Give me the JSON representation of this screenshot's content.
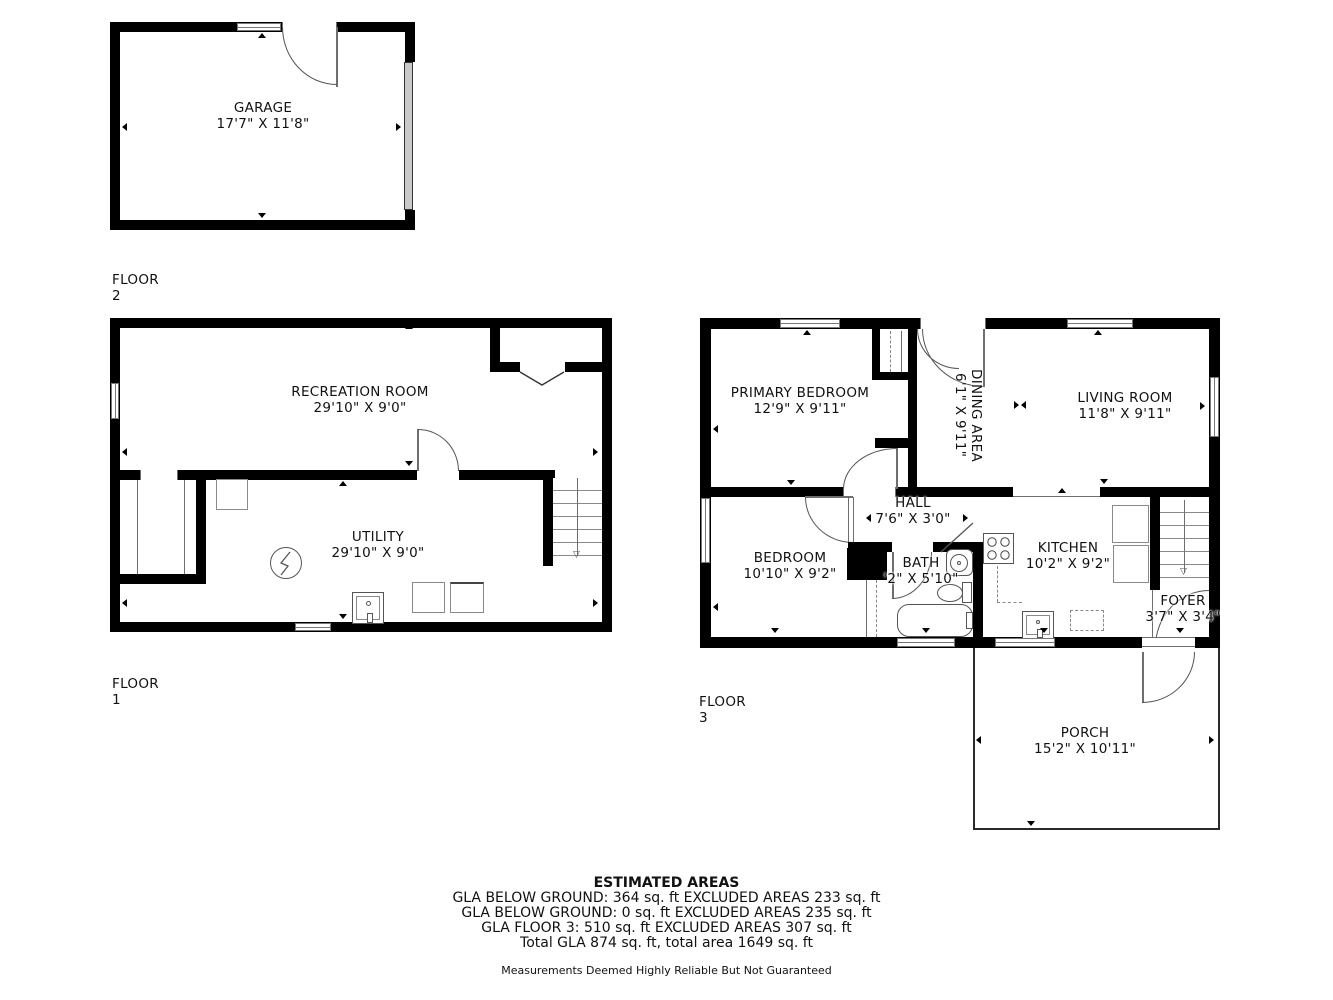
{
  "floor_plan": {
    "colors": {
      "walls": "#000000",
      "background": "#ffffff",
      "fixture_lines": "#8a8a8a"
    },
    "floor2": {
      "label": "FLOOR 2",
      "garage": {
        "name": "GARAGE",
        "dims": "17'7\" X 11'8\""
      }
    },
    "floor1": {
      "label": "FLOOR 1",
      "recreation": {
        "name": "RECREATION ROOM",
        "dims": "29'10\" X 9'0\""
      },
      "utility": {
        "name": "UTILITY",
        "dims": "29'10\" X 9'0\""
      }
    },
    "floor3": {
      "label": "FLOOR 3",
      "primary_bedroom": {
        "name": "PRIMARY BEDROOM",
        "dims": "12'9\" X 9'11\""
      },
      "dining": {
        "name": "DINING AREA",
        "dims": "6'1\" X 9'11\""
      },
      "living": {
        "name": "LIVING ROOM",
        "dims": "11'8\" X 9'11\""
      },
      "hall": {
        "name": "HALL",
        "dims": "7'6\" X 3'0\""
      },
      "bedroom": {
        "name": "BEDROOM",
        "dims": "10'10\" X 9'2\""
      },
      "bath": {
        "name": "BATH",
        "dims": "'2\" X 5'10\""
      },
      "kitchen": {
        "name": "KITCHEN",
        "dims": "10'2\" X 9'2\""
      },
      "foyer": {
        "name": "FOYER",
        "dims": "3'7\" X 3'4\""
      },
      "porch": {
        "name": "PORCH",
        "dims": "15'2\" X 10'11\""
      }
    },
    "summary": {
      "title": "ESTIMATED AREAS",
      "lines": [
        "GLA BELOW GROUND: 364 sq. ft EXCLUDED AREAS 233 sq. ft",
        "GLA BELOW GROUND: 0 sq. ft EXCLUDED AREAS 235 sq. ft",
        "GLA FLOOR 3: 510 sq. ft EXCLUDED AREAS 307 sq. ft",
        "Total GLA 874 sq. ft, total area 1649 sq. ft"
      ],
      "disclaimer": "Measurements Deemed Highly Reliable But Not Guaranteed"
    }
  }
}
